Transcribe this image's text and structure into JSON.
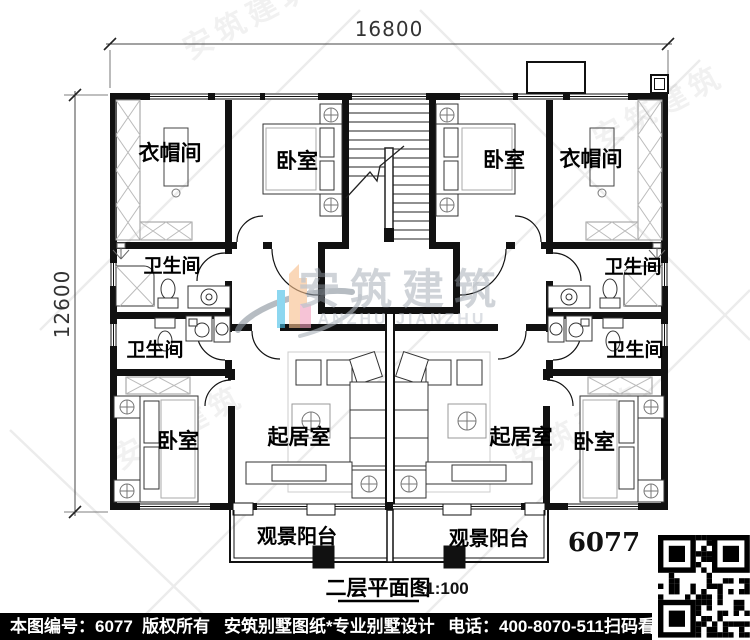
{
  "dimensions": {
    "width_mm": "16800",
    "height_mm": "12600"
  },
  "labels": {
    "cloakroom": "衣帽间",
    "bedroom": "卧室",
    "bathroom": "卫生间",
    "living_room": "起居室",
    "balcony": "观景阳台"
  },
  "plan_number": "6077",
  "title": {
    "name": "二层平面图",
    "scale": "1:100"
  },
  "watermark": {
    "cn": "安筑建筑",
    "en": "ANZHU JIANZHU"
  },
  "footer": {
    "sheet_no": "本图编号：6077",
    "copyright": "版权所有",
    "brand": "安筑别墅图纸*专业别墅设计",
    "phone": "电话：400-8070-511",
    "scan_hint": "扫码看图"
  }
}
